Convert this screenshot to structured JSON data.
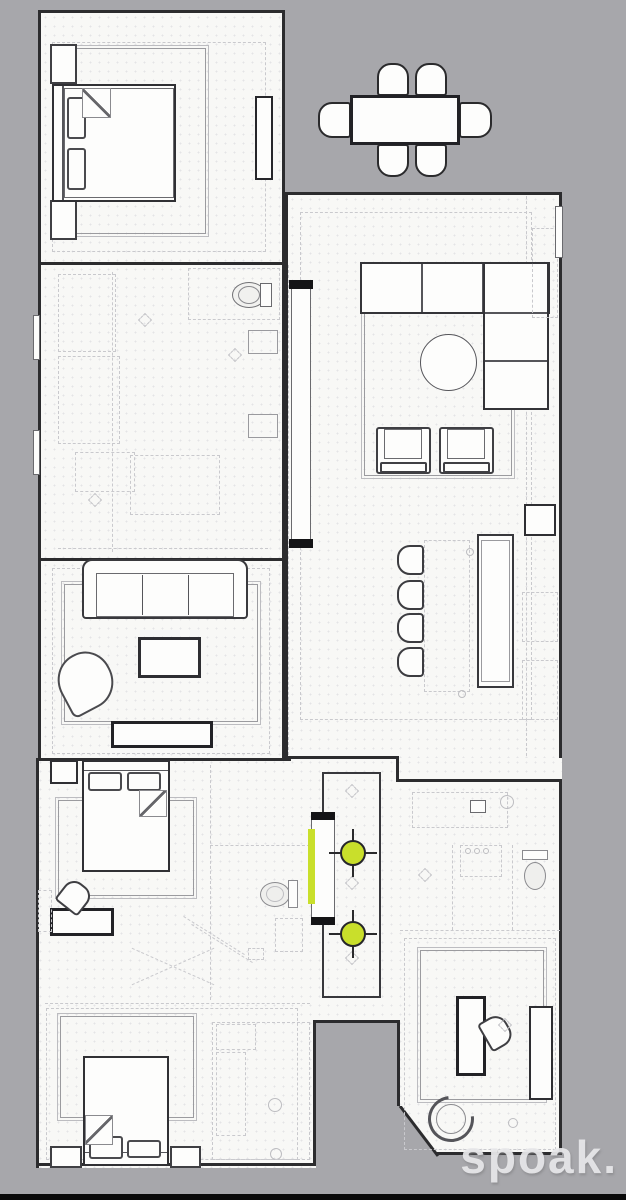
{
  "watermark": {
    "text": "spoak."
  },
  "colors": {
    "background": "#a7a7ab",
    "floor": "#f8f8f6",
    "wall": "#2c2c2e",
    "accent-green": "#c9df2b",
    "line-dark": "#3f3f43",
    "line-mid": "#6a6a6e",
    "line-faint": "#c9c9cd"
  },
  "fixtures": {
    "ceiling_lights": [
      {
        "x": 353,
        "y": 853
      },
      {
        "x": 353,
        "y": 934
      }
    ],
    "highlight_strip": {
      "x": 308,
      "y": 829,
      "width": 7,
      "height": 75
    }
  }
}
